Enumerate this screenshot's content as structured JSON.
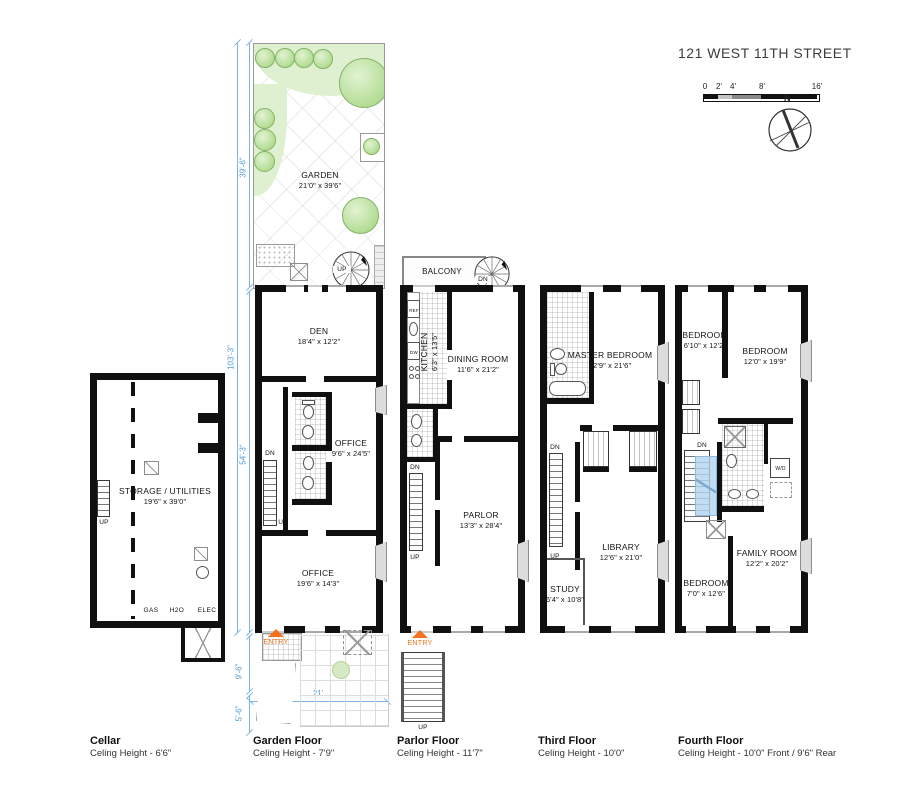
{
  "title": "121 WEST 11TH STREET",
  "scale_bar": {
    "t0": "0",
    "t2": "2'",
    "t4": "4'",
    "t8": "8'",
    "t16": "16'"
  },
  "compass": {
    "north": "N"
  },
  "dimensions": {
    "garden_depth": "39'-6\"",
    "lot_depth": "103'-3\"",
    "house_depth": "54'-3\"",
    "front_yard_depth": "9'-6\"",
    "stoop_depth": "5'-6\"",
    "lot_width": "21'"
  },
  "garden": {
    "label": "GARDEN",
    "size": "21'0\" x 39'6\"",
    "spiral_up": "UP"
  },
  "cellar": {
    "storage_label": "STORAGE / UTILITIES",
    "storage_size": "19'6\" x 39'0\"",
    "gas": "GAS",
    "h2o": "H2O",
    "elec": "ELEC",
    "up": "UP",
    "footer_name": "Cellar",
    "footer_ceiling": "Celing Height - 6'6\""
  },
  "garden_floor": {
    "den_label": "DEN",
    "den_size": "18'4\" x 12'2\"",
    "office_rear_label": "OFFICE",
    "office_rear_size": "9'6\" x 24'5\"",
    "office_front_label": "OFFICE",
    "office_front_size": "19'6\" x 14'3\"",
    "dn": "DN",
    "up": "UP",
    "entry": "ENTRY",
    "footer_name": "Garden Floor",
    "footer_ceiling": "Celing Height - 7'9\""
  },
  "parlor_floor": {
    "balcony": "BALCONY",
    "spiral_dn": "DN",
    "kitchen_label": "KITCHEN",
    "kitchen_size": "6'3\" x 13'5\"",
    "ref": "REF",
    "dw": "DW",
    "dining_label": "DINING ROOM",
    "dining_size": "11'6\" x 21'2\"",
    "parlor_label": "PARLOR",
    "parlor_size": "13'3\" x 28'4\"",
    "dn": "DN",
    "up": "UP",
    "entry": "ENTRY",
    "stoop_up": "UP",
    "footer_name": "Parlor Floor",
    "footer_ceiling": "Celing Height - 11'7\""
  },
  "third_floor": {
    "master_label": "MASTER BEDROOM",
    "master_size": "12'9\" x 21'6\"",
    "library_label": "LIBRARY",
    "library_size": "12'6\" x 21'0\"",
    "study_label": "STUDY",
    "study_size": "6'4\" x 10'8\"",
    "dn": "DN",
    "up": "UP",
    "footer_name": "Third Floor",
    "footer_ceiling": "Celing Height - 10'0\""
  },
  "fourth_floor": {
    "bedroom_rear_small_label": "BEDROOM",
    "bedroom_rear_small_size": "6'10\" x 12'2\"",
    "bedroom_rear_label": "BEDROOM",
    "bedroom_rear_size": "12'0\" x 19'9\"",
    "family_label": "FAMILY ROOM",
    "family_size": "12'2\" x 20'2\"",
    "bedroom_front_label": "BEDROOM",
    "bedroom_front_size": "7'0\" x 12'6\"",
    "wd": "W/D",
    "dn": "DN",
    "footer_name": "Fourth Floor",
    "footer_ceiling": "Celing Height - 10'0\" Front / 9'6\" Rear"
  },
  "colors": {
    "wall": "#101010",
    "dimension_blue": "#6fa8dc",
    "entry_orange": "#f4711f",
    "garden_green": "#def0cf",
    "skylight_blue": "#bcd8ef"
  }
}
